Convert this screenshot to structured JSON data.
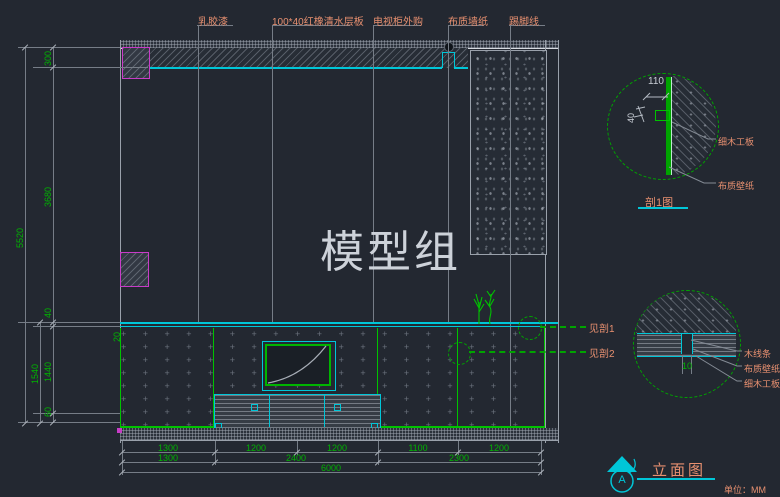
{
  "watermark": "模型组",
  "materials_callouts": [
    {
      "label": "乳胶漆"
    },
    {
      "label": "100*40红橡清水层板"
    },
    {
      "label": "电视柜外购"
    },
    {
      "label": "布质墙纸"
    },
    {
      "label": "踢脚线"
    }
  ],
  "section_callouts": [
    {
      "label": "见剖1"
    },
    {
      "label": "见剖2"
    }
  ],
  "dims": {
    "left": {
      "overall": "5520",
      "sub_total": "1540",
      "chain": [
        "300",
        "3680",
        "40",
        "1440",
        "60"
      ],
      "panel_thickness": "20"
    },
    "bottom": {
      "row1": [
        "1300",
        "1200",
        "1200",
        "1100",
        "1200"
      ],
      "row2": [
        "1300",
        "2400",
        "2300"
      ],
      "overall": "6000"
    }
  },
  "detail_1": {
    "title": "剖1图",
    "dim_width": "110",
    "dim_depth": "40",
    "callouts": [
      "细木工板",
      "布质壁纸"
    ]
  },
  "detail_2": {
    "dim_gap": "10",
    "callouts": [
      "木线条",
      "布质壁纸",
      "细木工板"
    ]
  },
  "title_block": {
    "view_title": "立面图",
    "marker_letter": "A",
    "units_note": "单位：MM"
  },
  "colors": {
    "background": "#232831",
    "dimension_green": "#00b400",
    "line_green": "#00c300",
    "cyan": "#00c6d8",
    "callout_orange": "#e89070",
    "magenta": "#c83cc8",
    "line_gray": "#8f949c",
    "watermark_gray": "#cdd2d9"
  }
}
